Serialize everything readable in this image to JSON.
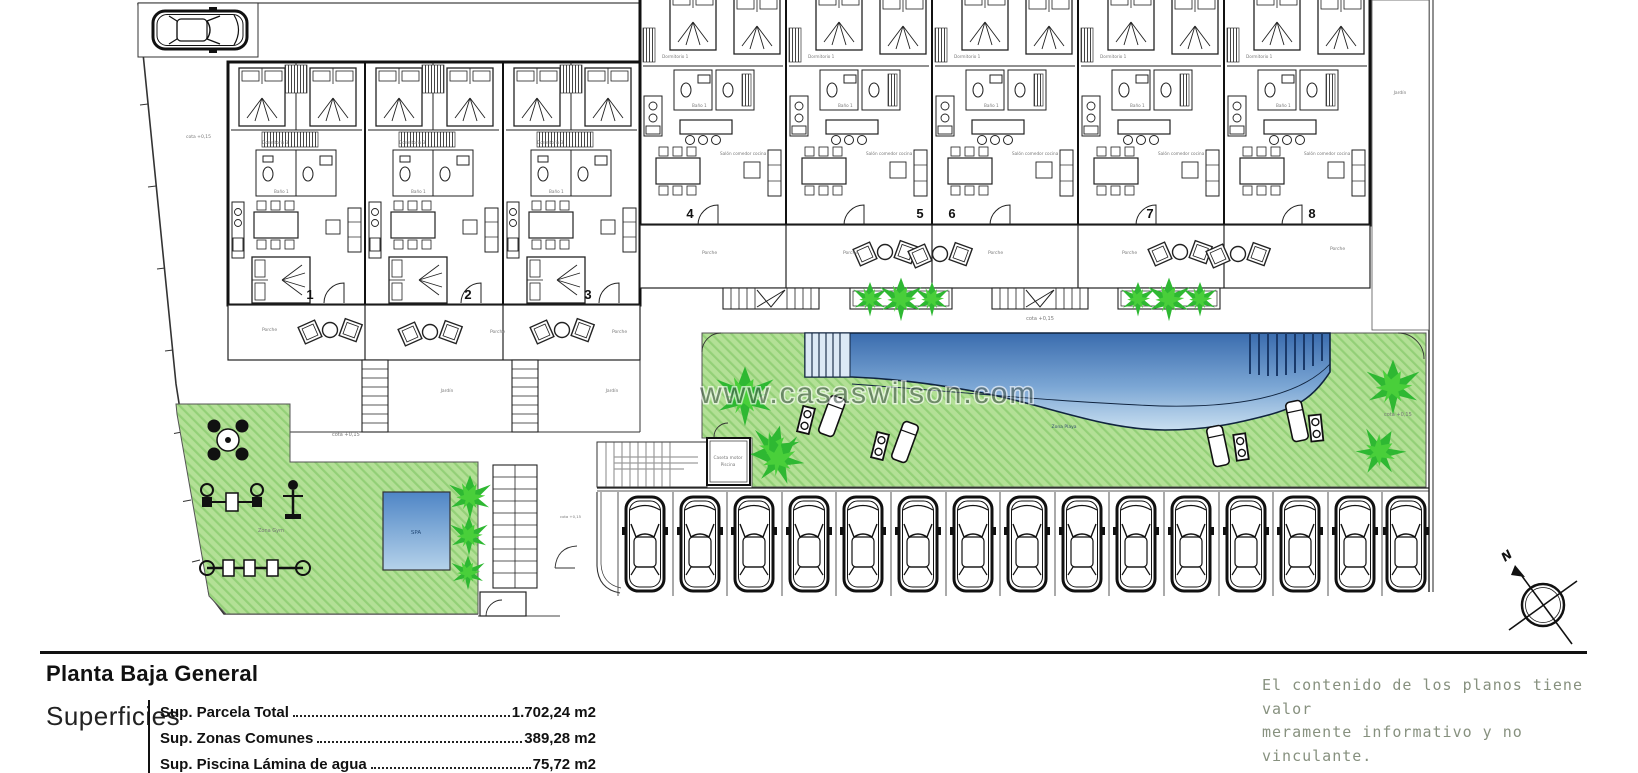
{
  "title_block": {
    "title": "Planta Baja General",
    "section_label": "Superficies",
    "rows": [
      {
        "label": "Sup. Parcela Total",
        "value": "1.702,24 m2"
      },
      {
        "label": "Sup. Zonas Comunes",
        "value": "389,28 m2"
      },
      {
        "label": "Sup. Piscina Lámina de agua",
        "value": "75,72 m2"
      }
    ],
    "disclaimer": {
      "line1": "El contenido de los planos tiene valor",
      "line2": "meramente informativo y no vinculante."
    }
  },
  "watermark": {
    "text": "www.casaswilson.com"
  },
  "compass": {
    "north": "N"
  },
  "plan": {
    "cota_label": "cota +0,15",
    "units": [
      {
        "number": "1"
      },
      {
        "number": "2"
      },
      {
        "number": "3"
      },
      {
        "number": "4"
      },
      {
        "number": "5"
      },
      {
        "number": "6"
      },
      {
        "number": "7"
      },
      {
        "number": "8"
      }
    ],
    "labels": {
      "porche": "Porche",
      "jardin": "Jardín",
      "spa": "SPA",
      "zona_gym": "Zona Gym",
      "zona_playa": "Zona Playa",
      "caseta_line1": "Caseta motor",
      "caseta_line2": "Piscina",
      "dormitorio": "Dormitorio 3",
      "dormitorio_1": "Dormitorio 1",
      "bano": "Baño 1",
      "salon": "Salón comedor cocina"
    },
    "colors": {
      "garden_green": "#b3e096",
      "garden_hatch": "#93d077",
      "palm_green": "#2eb832",
      "pool_dark": "#3a6cae",
      "pool_light": "#c9dff0",
      "line": "#1a1a1a"
    }
  }
}
